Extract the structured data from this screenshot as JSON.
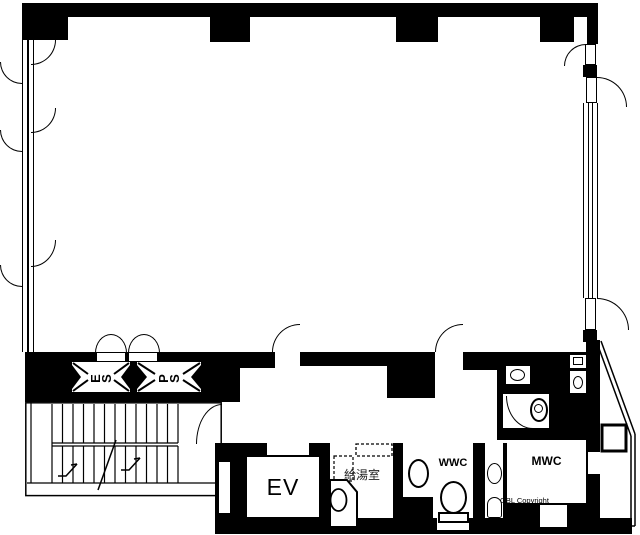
{
  "labels": {
    "elevator": "EV",
    "kitchenette": "給湯室",
    "womens_wc": "WWC",
    "mens_wc": "MWC",
    "electrical_shaft": "ES",
    "pipe_shaft": "PS",
    "copyright": "OBL Copyright"
  },
  "colors": {
    "wall": "#000000",
    "background": "#ffffff",
    "line": "#000000"
  }
}
